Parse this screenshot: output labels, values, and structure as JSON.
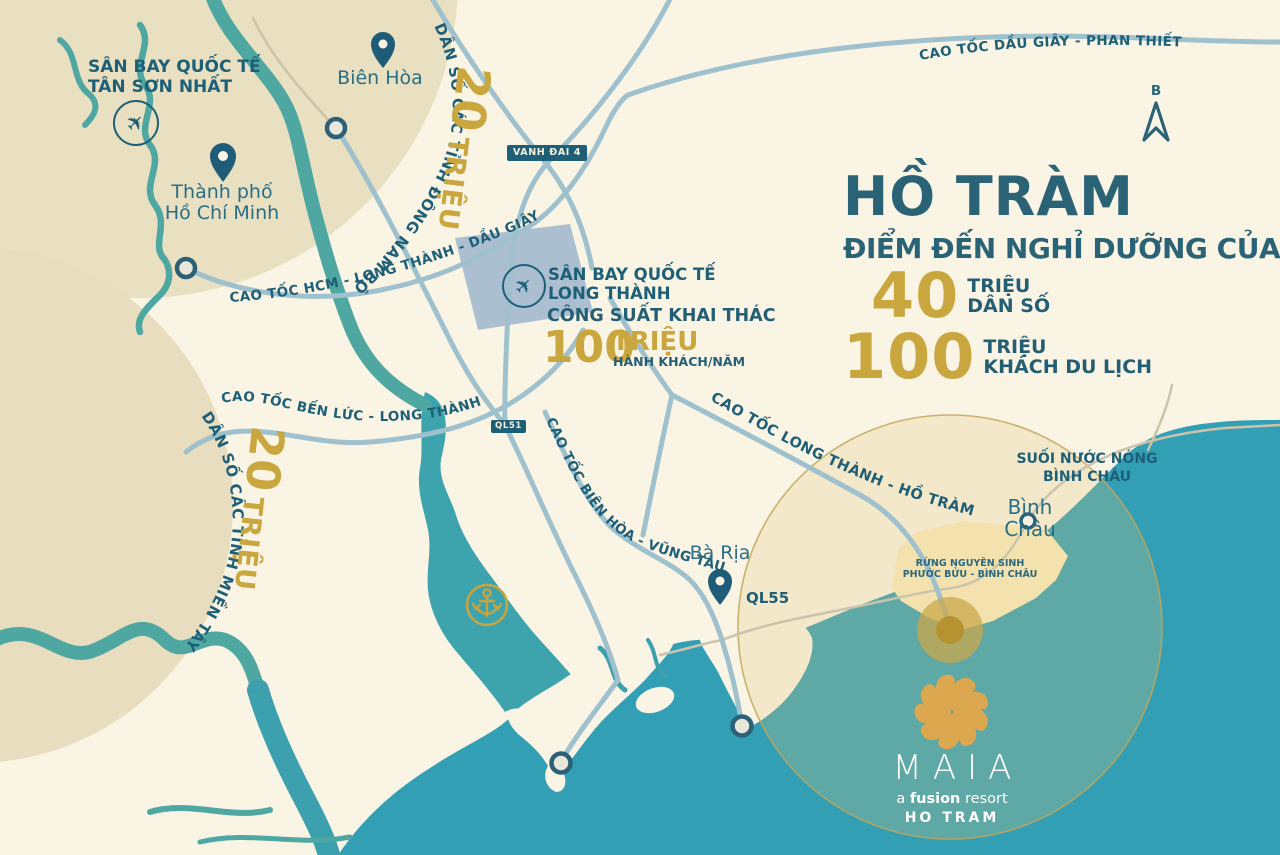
{
  "header": {
    "title": "HỒ TRÀM",
    "subtitle": "ĐIỂM ĐẾN NGHỈ DƯỠNG CỦA",
    "stat1_number": "40",
    "stat1_unit": "TRIỆU",
    "stat1_label": "DÂN SỐ",
    "stat2_number": "100",
    "stat2_unit": "TRIỆU",
    "stat2_label": "KHÁCH DU LỊCH"
  },
  "airports": {
    "tan_son_nhat_line1": "SÂN BAY QUỐC TẾ",
    "tan_son_nhat_line2": "TÂN SƠN NHẤT",
    "long_thanh_line1": "SÂN BAY QUỐC TẾ",
    "long_thanh_line2": "LONG THÀNH",
    "capacity_label": "CÔNG SUẤT  KHAI THÁC",
    "capacity_number": "100",
    "capacity_unit": "TRIỆU",
    "capacity_suffix": "HÀNH KHÁCH/NĂM"
  },
  "cities": {
    "bien_hoa": "Biên Hòa",
    "hcmc_line1": "Thành phố",
    "hcmc_line2": "Hồ Chí Minh",
    "ba_ria": "Bà Rịa",
    "binh_chau": "Bình Châu"
  },
  "regions": {
    "southeast_caption": "DÂN SỐ CÁC TỈNH ĐÔNG NAM BỘ",
    "southeast_number": "20",
    "southeast_unit": "TRIỆU",
    "mekong_caption": "DÂN SỐ CÁC TỈNH MIỀN TÂY",
    "mekong_number": "20",
    "mekong_unit": "TRIỆU"
  },
  "roads": {
    "hcm_lt_dg": "CAO TỐC HCM - LONG THÀNH - DẦU GIÂY",
    "dg_pt": "CAO TỐC DẦU GIÂY - PHAN THIẾT",
    "bl_lt": "CAO TỐC BẾN LỨC - LONG THÀNH",
    "bh_vt": "CAO TỐC BIÊN HÒA - VŨNG TÀU",
    "lt_ht": "CAO TỐC LONG THÀNH - HỒ TRÀM",
    "vanh_dai_4": "VANH ĐAI 4",
    "ql51": "QL51",
    "ql55": "QL55"
  },
  "pois": {
    "hot_spring_line1": "SUỐI NƯỚC NÓNG",
    "hot_spring_line2": "BÌNH CHÂU",
    "forest_line1": "RỪNG NGUYÊN SINH",
    "forest_line2": "PHƯỚC BỬU - BÌNH CHÂU"
  },
  "compass": {
    "north_label": "B"
  },
  "resort": {
    "name": "MAIA",
    "tagline_a": "a",
    "tagline_fusion": "fusion",
    "tagline_resort": "resort",
    "location": "HO TRAM"
  },
  "colors": {
    "background_cream": "#FAF4E4",
    "region_tan": "#E9DFC1",
    "sea_teal": "#339FB5",
    "river_teal": "#4EA7A1",
    "estuary_teal": "#3DA4AE",
    "highway_blue": "#9FC0CD",
    "minor_road": "#CBC3AB",
    "dark_teal_text": "#1E5F78",
    "title_teal": "#2A6376",
    "gold_accent": "#C9A63E",
    "airport_fill": "#ABBFD1",
    "forest_beige": "#F3E2AD",
    "badge_bg": "#1E5F78",
    "flower_gold": "#DCA84F"
  }
}
